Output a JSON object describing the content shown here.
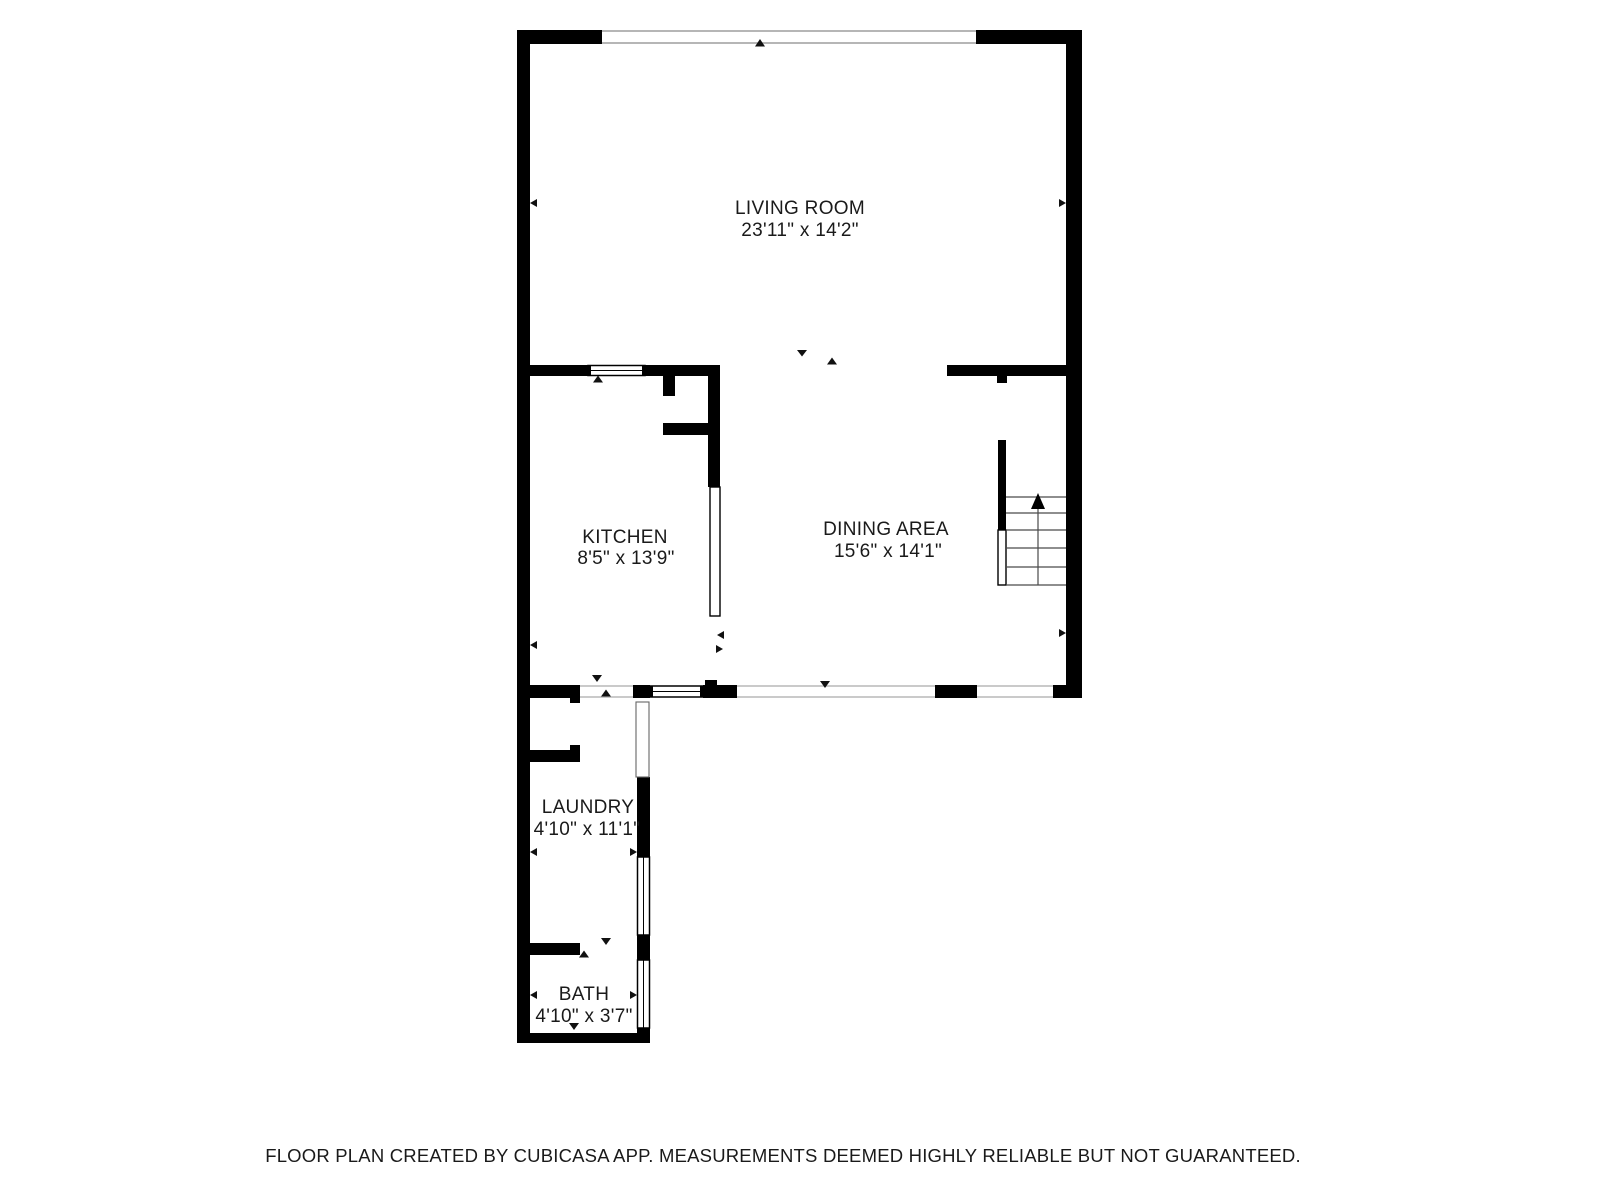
{
  "colors": {
    "wall": "#000000",
    "room_text": "#1a1a1a",
    "footer_text": "#a6a6a6",
    "opening_line": "#b8b8b8",
    "window_line": "#9e9e9e",
    "stair_line": "#4a4a4a",
    "marker": "#111111"
  },
  "rooms": [
    {
      "id": "living-room",
      "name": "LIVING ROOM",
      "dimensions": "23'11\" x 14'2\""
    },
    {
      "id": "kitchen",
      "name": "KITCHEN",
      "dimensions": "8'5\" x 13'9\""
    },
    {
      "id": "dining-area",
      "name": "DINING AREA",
      "dimensions": "15'6\" x 14'1\""
    },
    {
      "id": "laundry",
      "name": "LAUNDRY",
      "dimensions": "4'10\" x 11'1\""
    },
    {
      "id": "bath",
      "name": "BATH",
      "dimensions": "4'10\" x 3'7\""
    }
  ],
  "stairs": {
    "icon": "up-arrow"
  },
  "footer": {
    "disclaimer": "FLOOR PLAN CREATED BY CUBICASA APP. MEASUREMENTS DEEMED HIGHLY RELIABLE BUT NOT GUARANTEED."
  }
}
